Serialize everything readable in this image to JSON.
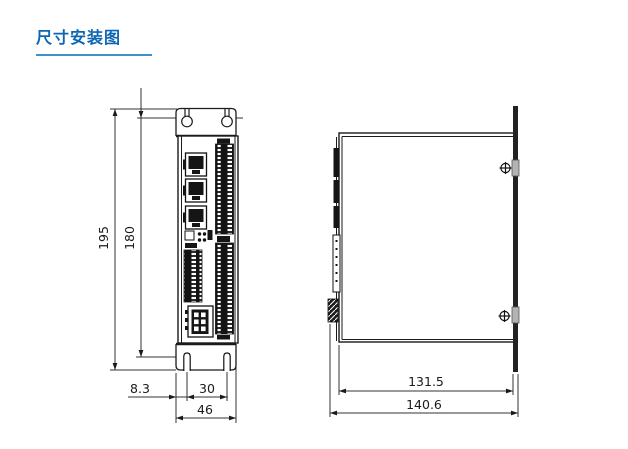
{
  "title": {
    "text": "尺寸安装图"
  },
  "colors": {
    "accent": "#0d66b3",
    "underline": "#4090cc",
    "line": "#1a1a1a"
  },
  "dimensions": {
    "front": {
      "overall_height": "195",
      "mounting_height": "180",
      "edge_to_first_hole": "8.3",
      "hole_spacing": "30",
      "overall_width": "46"
    },
    "side": {
      "body_depth": "131.5",
      "overall_depth": "140.6"
    }
  }
}
